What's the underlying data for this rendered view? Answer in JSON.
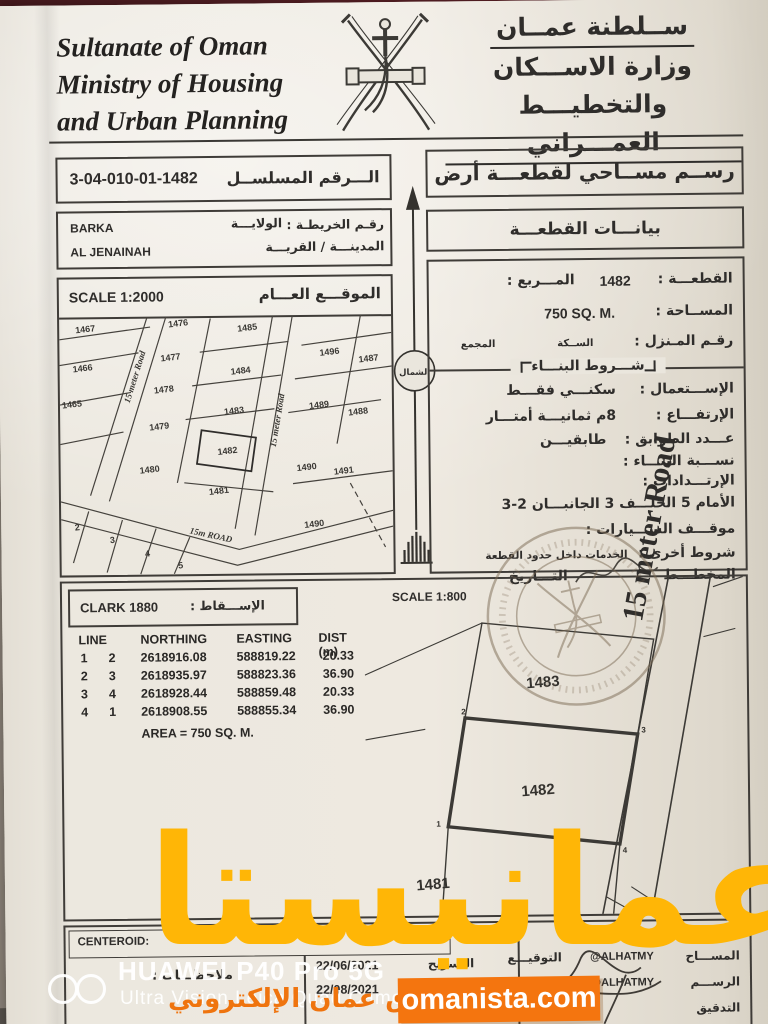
{
  "header": {
    "en_line1": "Sultanate of Oman",
    "en_line2": "Ministry of Housing",
    "en_line3": "and Urban Planning",
    "ar_line1": "ســلطنة عمــان",
    "ar_line2": "وزارة الاســـكان",
    "ar_line3": "والتخطيـــط العمـــراني"
  },
  "left": {
    "serial_label": "الـــرقم المسلســل",
    "serial_value": "3-04-010-01-1482",
    "map_no_label": "رقـم الخريطـة :",
    "wilaya_label": "الولايـــة",
    "wilaya_value": "BARKA",
    "town_label": "المدينـــة / القريـــة",
    "town_value": "AL JENAINAH",
    "overview": {
      "title": "الموقـــع العـــام",
      "scale": "SCALE 1:2000",
      "road_left": "15 meter Road",
      "road_mid": "15 meter Road",
      "road_bottom": "15m ROAD",
      "plots": [
        "1467",
        "1476",
        "1485",
        "1466",
        "1477",
        "1484",
        "1496",
        "1487",
        "1465",
        "1478",
        "1483",
        "1489",
        "1488",
        "1479",
        "1482",
        "1480",
        "1490",
        "1491",
        "1481",
        "1490",
        "2",
        "3",
        "4",
        "5"
      ]
    }
  },
  "right": {
    "title": "رســم مســاحي لقطعـــة أرض",
    "subtitle": "بيانـــات القطعـــة",
    "plot_label": "القطعـــة :",
    "plot_value": "1482",
    "square_label": "المـــربع :",
    "area_label": "المســاحة :",
    "area_value": "750 SQ. M.",
    "house_label": "رقـم المـنزل :",
    "street_label": "الســكة",
    "complex_label": "المجمع",
    "conditions_title": "شـــروط البنـــاء",
    "use_label": "الإســـتعمال :",
    "use_value": "سكنـــي فقـــط",
    "height_label": "الإرتفـــاع :",
    "height_value": "8م  ثمانيـــة أمتـــار",
    "floors_label": "عـــدد الطوابق :",
    "floors_value": "طابقيـــن",
    "ratio_label": "نســـبة البنـــاء :",
    "setbacks_label": "الإرتـــدادات :",
    "setbacks_value": "الأمام 5   الخلـــف 3   الجانبـــان 2-3",
    "parking_label": "موقـــف الســـيارات :",
    "other_label": "شروط أخرى :",
    "other_value": "الخدمات داخل حدود القطعة",
    "planner_label": "المخطـــط",
    "date_label": "التـــاريخ"
  },
  "north": {
    "label": "الشمال"
  },
  "survey": {
    "projection_en": "CLARK 1880",
    "projection_ar": "الإســـقاط :",
    "detail_scale": "SCALE 1:800",
    "headers": {
      "line": "LINE",
      "northing": "NORTHING",
      "easting": "EASTING",
      "dist": "DIST (m)"
    },
    "rows": [
      {
        "from": "1",
        "to": "2",
        "northing": "2618916.08",
        "easting": "588819.22",
        "dist": "20.33"
      },
      {
        "from": "2",
        "to": "3",
        "northing": "2618935.97",
        "easting": "588823.36",
        "dist": "36.90"
      },
      {
        "from": "3",
        "to": "4",
        "northing": "2618928.44",
        "easting": "588859.48",
        "dist": "20.33"
      },
      {
        "from": "4",
        "to": "1",
        "northing": "2618908.55",
        "easting": "588855.34",
        "dist": "36.90"
      }
    ],
    "area_line": "AREA = 750 SQ. M.",
    "detail_plots": [
      "1483",
      "1482",
      "1481"
    ],
    "corner_digits": [
      "2",
      "3",
      "4",
      "1"
    ],
    "detail_road": "15 meter Road"
  },
  "bottom": {
    "centeroid": "CENTEROID:",
    "notes": "ملاحظـــات :",
    "date_rows": [
      {
        "date": "22/06/2021",
        "label": "التسريح"
      },
      {
        "date": "22/08/2021",
        "label": "التـــاريخ"
      }
    ],
    "sign_rows": [
      {
        "role": "المســـاح",
        "name": "@ALHATMY",
        "sig": "التوقيـــع"
      },
      {
        "role": "الرســـم",
        "name": "@ALHATMY",
        "sig": "التوقيـــع"
      },
      {
        "role": "التدقيق",
        "name": "",
        "sig": ""
      }
    ]
  },
  "watermarks": {
    "big": "عمانيستا",
    "small": "سوق عمان الإلكتروني",
    "badge": "omanista.com",
    "camera_line1": "HUAWEI P40 Pro 5G",
    "camera_line2": "Ultra Vision Leica Quad Camera"
  }
}
